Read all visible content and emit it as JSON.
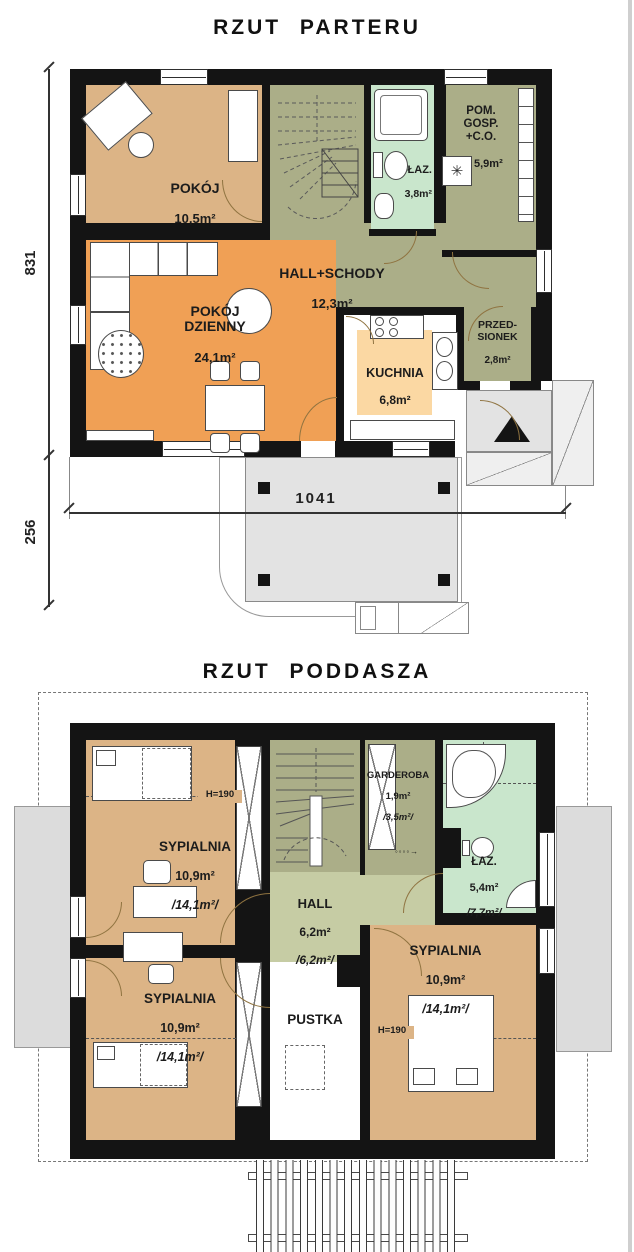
{
  "parter": {
    "title": "RZUT PARTERU",
    "rooms": {
      "pokoj": {
        "name": "POKÓJ",
        "area": "10,5m²"
      },
      "dzienny": {
        "name": "POKÓJ\nDZIENNY",
        "area": "24,1m²"
      },
      "hall": {
        "name": "HALL+SCHODY",
        "area": "12,3m²"
      },
      "laz": {
        "name": "ŁAZ.",
        "area": "3,8m²"
      },
      "pom_gosp": {
        "name": "POM.\nGOSP.\n+C.O.",
        "area": "5,9m²"
      },
      "kuchnia": {
        "name": "KUCHNIA",
        "area": "6,8m²"
      },
      "przedsionek": {
        "name": "PRZED-\nSIONEK",
        "area": "2,8m²"
      }
    },
    "dimensions": {
      "left_total": "831",
      "left_terrace": "256",
      "terrace_width": "1041"
    }
  },
  "poddasze": {
    "title": "RZUT PODDASZA",
    "rooms": {
      "sypialnia_nw": {
        "name": "SYPIALNIA",
        "area": "10,9m²",
        "area2": "/14,1m²/"
      },
      "sypialnia_sw": {
        "name": "SYPIALNIA",
        "area": "10,9m²",
        "area2": "/14,1m²/"
      },
      "sypialnia_se": {
        "name": "SYPIALNIA",
        "area": "10,9m²",
        "area2": "/14,1m²/"
      },
      "hall": {
        "name": "HALL",
        "area": "6,2m²",
        "area2": "/6,2m²/"
      },
      "garderoba": {
        "name": "GARDEROBA",
        "area": "1,9m²",
        "area2": "/3,5m²/"
      },
      "laz": {
        "name": "ŁAZ.",
        "area": "5,4m²",
        "area2": "/7,7m²/"
      },
      "pustka": {
        "name": "PUSTKA"
      }
    },
    "labels": {
      "h190": "H=190",
      "access_arrow": "◦◦◦◦→"
    }
  }
}
